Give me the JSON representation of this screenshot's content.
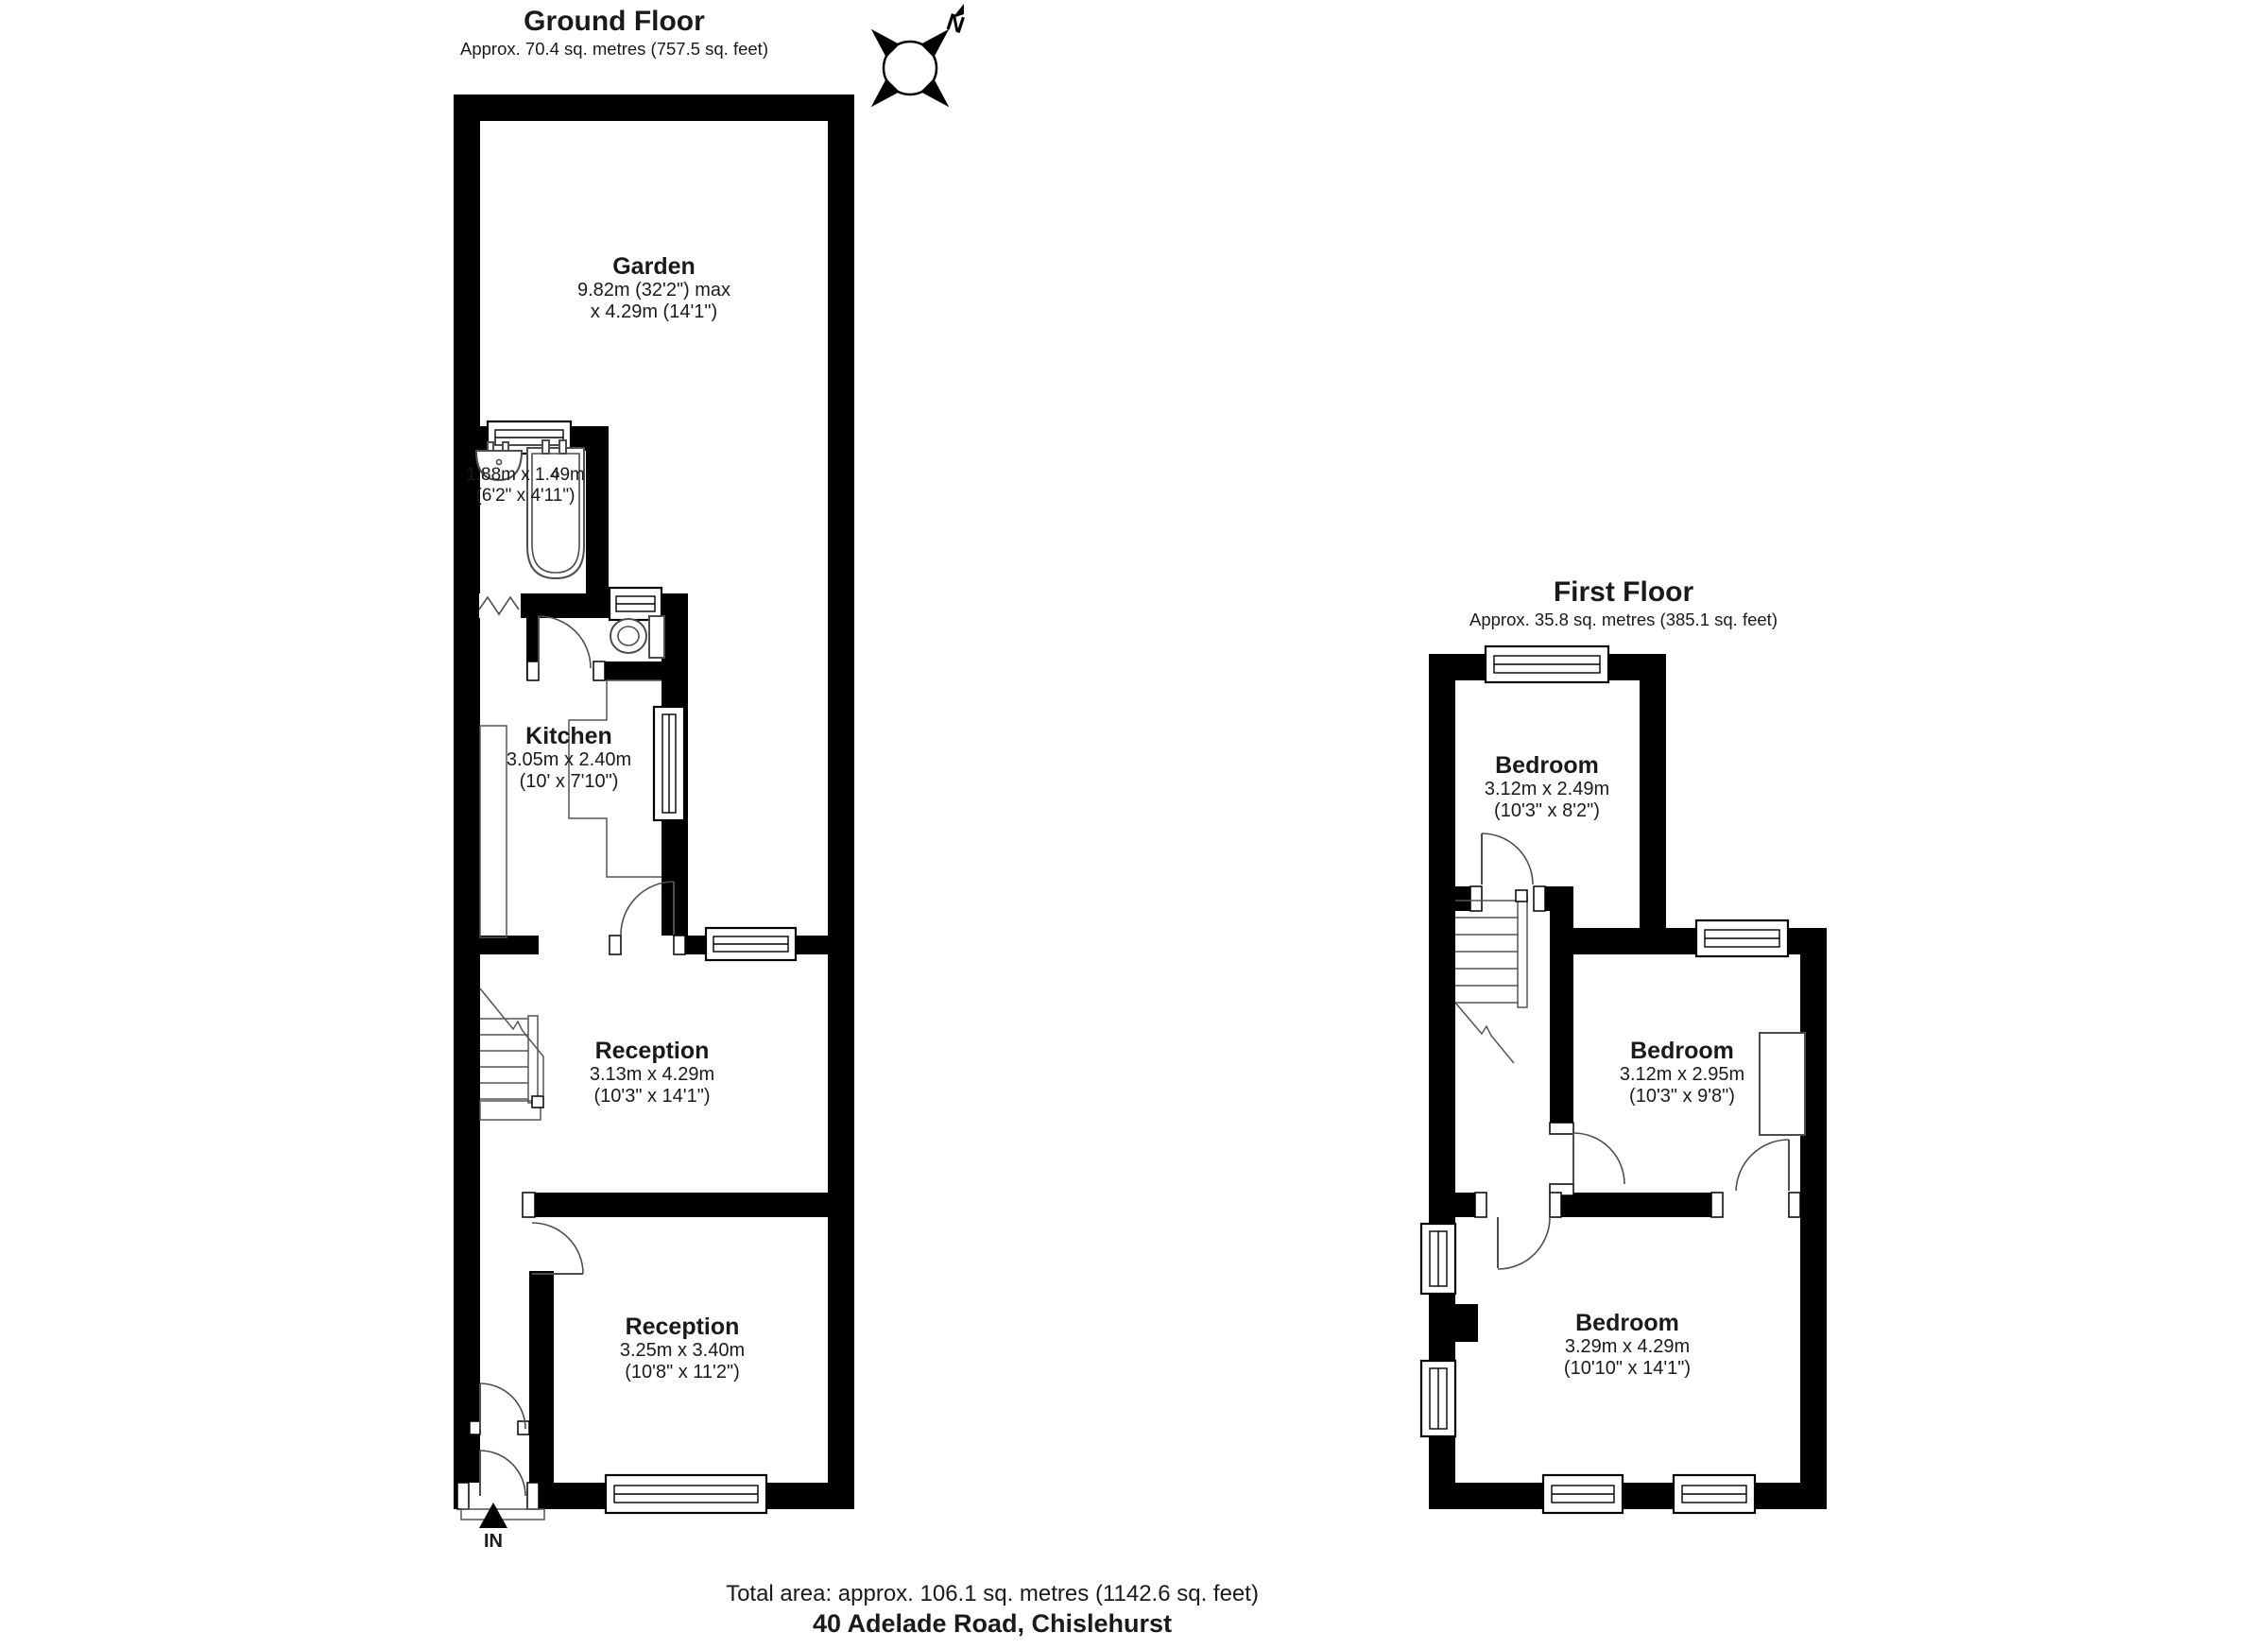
{
  "ground_floor": {
    "title": "Ground Floor",
    "subtitle": "Approx. 70.4 sq. metres (757.5 sq. feet)",
    "entrance_label": "IN",
    "rooms": {
      "garden": {
        "name": "Garden",
        "dims1": "9.82m (32'2\") max",
        "dims2": "x 4.29m (14'1\")"
      },
      "bathroom": {
        "dims1": "1.88m x 1.49m",
        "dims2": "(6'2\" x 4'11\")"
      },
      "kitchen": {
        "name": "Kitchen",
        "dims1": "3.05m x 2.40m",
        "dims2": "(10' x 7'10\")"
      },
      "reception_rear": {
        "name": "Reception",
        "dims1": "3.13m x 4.29m",
        "dims2": "(10'3\" x 14'1\")"
      },
      "reception_front": {
        "name": "Reception",
        "dims1": "3.25m x 3.40m",
        "dims2": "(10'8\" x 11'2\")"
      }
    }
  },
  "first_floor": {
    "title": "First Floor",
    "subtitle": "Approx. 35.8 sq. metres (385.1 sq. feet)",
    "rooms": {
      "bedroom_rear": {
        "name": "Bedroom",
        "dims1": "3.12m x 2.49m",
        "dims2": "(10'3\" x 8'2\")"
      },
      "bedroom_middle": {
        "name": "Bedroom",
        "dims1": "3.12m x 2.95m",
        "dims2": "(10'3\" x 9'8\")"
      },
      "bedroom_front": {
        "name": "Bedroom",
        "dims1": "3.29m x 4.29m",
        "dims2": "(10'10\" x 14'1\")"
      }
    }
  },
  "compass": {
    "north_label": "N"
  },
  "footer": {
    "total_area": "Total area: approx. 106.1 sq. metres (1142.6 sq. feet)",
    "address": "40 Adelade Road, Chislehurst"
  },
  "colors": {
    "wall": "#000000",
    "fixture": "#4d4d4d",
    "background": "#ffffff"
  }
}
